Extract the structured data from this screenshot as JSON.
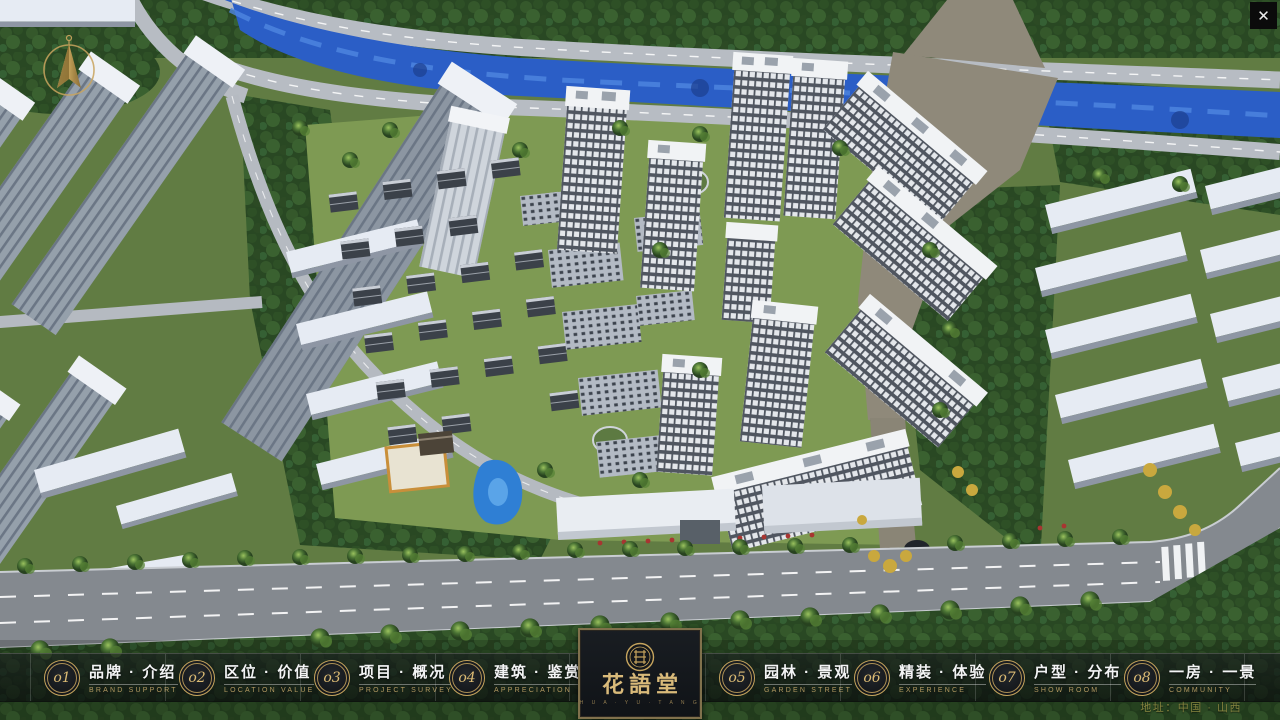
{
  "window": {
    "close_label": "✕"
  },
  "nav": {
    "items": [
      {
        "num": "o1",
        "zh": "品牌 · 介绍",
        "en": "BRAND SUPPORT"
      },
      {
        "num": "o2",
        "zh": "区位 · 价值",
        "en": "LOCATION VALUE"
      },
      {
        "num": "o3",
        "zh": "项目 · 概况",
        "en": "PROJECT SURVEY"
      },
      {
        "num": "o4",
        "zh": "建筑 · 鉴赏",
        "en": "APPRECIATION"
      },
      {
        "num": "o5",
        "zh": "园林 · 景观",
        "en": "GARDEN STREET"
      },
      {
        "num": "o6",
        "zh": "精装 · 体验",
        "en": "EXPERIENCE"
      },
      {
        "num": "o7",
        "zh": "户型 · 分布",
        "en": "SHOW ROOM"
      },
      {
        "num": "o8",
        "zh": "一房 · 一景",
        "en": "COMMUNITY"
      }
    ]
  },
  "logo": {
    "title": "花語堂",
    "subtitle": "H U A · Y U · T A N G"
  },
  "footer": {
    "address": "地址：中国 · 山西"
  },
  "colors": {
    "accent_gold": "#c7a55e",
    "nav_text": "#f3f4f5",
    "nav_subtext": "#b39a62",
    "address_text": "#85833f",
    "river_blue": "#2b5ec6"
  }
}
